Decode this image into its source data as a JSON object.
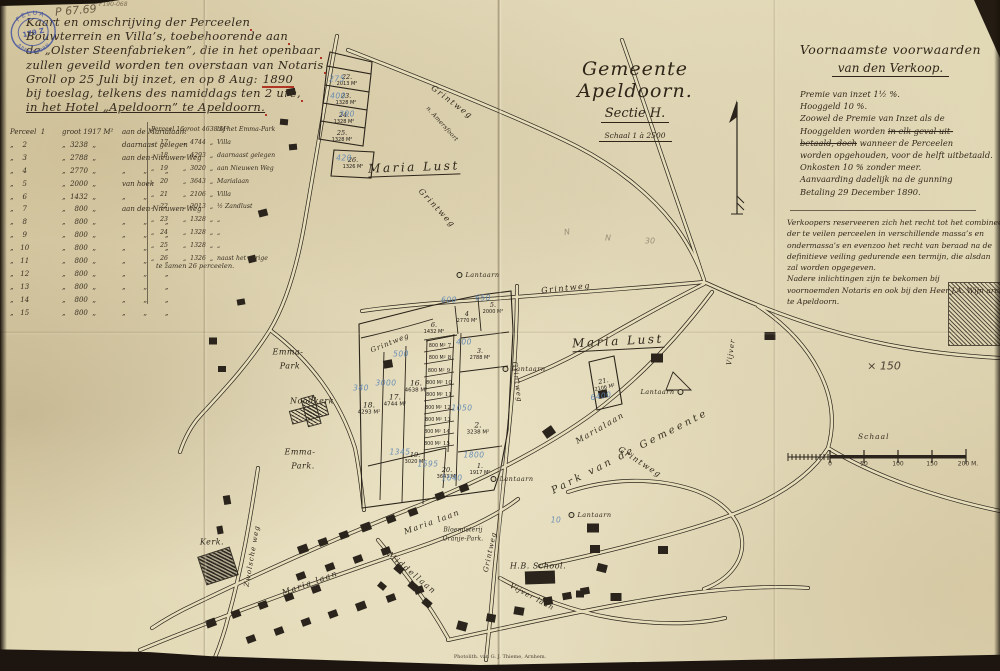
{
  "archive": {
    "stamp": {
      "arc_top": "FELUA",
      "center": "179 Z",
      "arc_bottom": "APELDOORN"
    },
    "ref_large": "P 67.69",
    "ref_small": "F190-068"
  },
  "title": {
    "lines": [
      {
        "t": "Kaart en omschrijving der Perceelen"
      },
      {
        "t": "Bouwterrein en Villa’s, toebehoorende aan"
      },
      {
        "t": "de „Olster Steenfabrieken”, die in het openbaar"
      },
      {
        "t": "zullen geveild worden ten overstaan van Notaris"
      },
      {
        "t": "Groll op 25 Juli bij inzet, en op 8 Aug: ",
        "red": "1890"
      },
      {
        "t": "bij toeslag, telkens des namiddags ten 2 ure,"
      },
      {
        "t": "in het Hotel „Apeldoorn” te Apeldoorn.",
        "cls": "und2"
      }
    ]
  },
  "sectie": {
    "line1": "Gemeente Apeldoorn.",
    "line2": "Sectie H.",
    "line3": "Schaal 1 à 2500"
  },
  "conditions": {
    "heading1": "Voornaamste voorwaarden",
    "heading2": "van den Verkoop.",
    "lines": [
      {
        "pre": "Premie van inzet 1½ %."
      },
      {
        "pre": "Hooggeld      10 %."
      },
      {
        "pre": "Zoowel de Premie van Inzet als de"
      },
      {
        "pre": "Hooggelden worden ",
        "struck": "in elk geval uit-"
      },
      {
        "struck": "betaald, doch",
        "post": " wanneer de Perceelen"
      },
      {
        "pre": "worden opgehouden, voor de helft uitbetaald."
      },
      {
        "pre": "Onkosten 10 % zonder meer."
      },
      {
        "pre": "Aanvaarding dadelijk na de gunning"
      },
      {
        "pre": "Betaling 29 December 1890."
      }
    ],
    "para2": [
      "Verkoopers reserveeren zich het recht tot het combineeren",
      "der te veilen perceelen in verschillende massa’s en",
      "ondermassa’s en evenzoo het recht van beraad na de",
      "definitieve veiling gedurende een termijn, die alsdan",
      "zal worden opgegeven.",
      "Nadere inlichtingen zijn te bekomen bij",
      "voornoemden Notaris en ook bij den Heer J.A. Wijn architect",
      "te Apeldoorn."
    ]
  },
  "parcel_table": {
    "left_rows": [
      {
        "no": "Perceel  1",
        "area": "groot 1917 M²",
        "note": "aan de Marialaan."
      },
      {
        "no": "„    2",
        "area": "„  3238  „",
        "note": "daarnaast gelegen"
      },
      {
        "no": "„    3",
        "area": "„  2788  „",
        "note": "aan den Nieuwen Weg"
      },
      {
        "no": "„    4",
        "area": "„  2770  „",
        "note": "„        „        „"
      },
      {
        "no": "„    5",
        "area": "„  2000  „",
        "note": "van hoek"
      },
      {
        "no": "„    6",
        "area": "„  1432  „",
        "note": "„        „"
      },
      {
        "no": "„    7",
        "area": "„    800  „",
        "note": "aan den Nieuwen Weg"
      },
      {
        "no": "„    8",
        "area": "„    800  „",
        "note": "„        „        „"
      },
      {
        "no": "„    9",
        "area": "„    800  „",
        "note": "„        „        „"
      },
      {
        "no": "„   10",
        "area": "„    800  „",
        "note": "„        „        „"
      },
      {
        "no": "„   11",
        "area": "„    800  „",
        "note": "„        „        „"
      },
      {
        "no": "„   12",
        "area": "„    800  „",
        "note": "„        „        „"
      },
      {
        "no": "„   13",
        "area": "„    800  „",
        "note": "„        „        „"
      },
      {
        "no": "„   14",
        "area": "„    800  „",
        "note": "„        „        „"
      },
      {
        "no": "„   15",
        "area": "„    800  „",
        "note": "„        „        „"
      }
    ],
    "right_rows": [
      {
        "no": "Perceel 16",
        "area": "groot 4638 M²",
        "note": "bij het Emma-Park"
      },
      {
        "no": "„   17",
        "area": "„  4744  „",
        "note": "Villa"
      },
      {
        "no": "„   18",
        "area": "„  4293  „",
        "note": "daarnaast gelegen"
      },
      {
        "no": "„   19",
        "area": "„  3020  „",
        "note": "aan Nieuwen Weg"
      },
      {
        "no": "„   20",
        "area": "„  3643  „",
        "note": "Marialaan"
      },
      {
        "no": "„   21",
        "area": "„  2106  „",
        "note": "Villa"
      },
      {
        "no": "„   22",
        "area": "„  2013  „",
        "note": "½ Zandlust"
      },
      {
        "no": "„   23",
        "area": "„  1328  „",
        "note": "„"
      },
      {
        "no": "„   24",
        "area": "„  1328  „",
        "note": "„"
      },
      {
        "no": "„   25",
        "area": "„  1328  „",
        "note": "„"
      },
      {
        "no": "„   26",
        "area": "„  1326  „",
        "note": "naast het vorige"
      }
    ],
    "footer": "te zamen 26 perceelen."
  },
  "map": {
    "labels": [
      {
        "t": "Maria Lust",
        "x": 414,
        "y": 168,
        "rot": -2,
        "cls": "big und"
      },
      {
        "t": "Maria Lust",
        "x": 618,
        "y": 342,
        "rot": -3,
        "cls": "big und"
      },
      {
        "t": "Grintweg",
        "x": 452,
        "y": 102,
        "rot": 37,
        "cls": "road"
      },
      {
        "t": "n. Amersfoort",
        "x": 442,
        "y": 124,
        "rot": 48,
        "cls": "tiny"
      },
      {
        "t": "Grintweg",
        "x": 437,
        "y": 208,
        "rot": 47,
        "cls": "road"
      },
      {
        "t": "Grintweg",
        "x": 566,
        "y": 288,
        "rot": -6,
        "cls": "road"
      },
      {
        "t": "Grintweg",
        "x": 390,
        "y": 343,
        "rot": -22,
        "cls": "road sm"
      },
      {
        "t": "Grintweg",
        "x": 517,
        "y": 382,
        "rot": 83,
        "cls": "road sm"
      },
      {
        "t": "Grintweg",
        "x": 640,
        "y": 462,
        "rot": 33,
        "cls": "road"
      },
      {
        "t": "Grintweg",
        "x": 490,
        "y": 552,
        "rot": -78,
        "cls": "road sm"
      },
      {
        "t": "Zwolsche weg",
        "x": 252,
        "y": 556,
        "rot": -80,
        "cls": "road sm"
      },
      {
        "t": "Marialaan",
        "x": 600,
        "y": 428,
        "rot": -30,
        "cls": "road"
      },
      {
        "t": "Park van de Gemeente",
        "x": 630,
        "y": 452,
        "rot": -27,
        "cls": "park"
      },
      {
        "t": "Vijver",
        "x": 731,
        "y": 352,
        "rot": -82,
        "cls": "road sm"
      },
      {
        "t": "Emma-",
        "x": 288,
        "y": 352,
        "cls": "place"
      },
      {
        "t": "Park",
        "x": 290,
        "y": 366,
        "cls": "place"
      },
      {
        "t": "Emma-",
        "x": 300,
        "y": 452,
        "cls": "place"
      },
      {
        "t": "Park.",
        "x": 303,
        "y": 466,
        "cls": "place"
      },
      {
        "t": "Noodkerk",
        "x": 312,
        "y": 401,
        "cls": "place sm"
      },
      {
        "t": "Kerk.",
        "x": 212,
        "y": 542,
        "cls": "place"
      },
      {
        "t": "Maria laan",
        "x": 310,
        "y": 583,
        "rot": -20,
        "cls": "road"
      },
      {
        "t": "Maria laan",
        "x": 432,
        "y": 522,
        "rot": -20,
        "cls": "road"
      },
      {
        "t": "Middellaan",
        "x": 412,
        "y": 573,
        "rot": 40,
        "cls": "road"
      },
      {
        "t": "Bloemisterij",
        "x": 463,
        "y": 530,
        "cls": "tiny"
      },
      {
        "t": "Oranje-Park.",
        "x": 463,
        "y": 539,
        "cls": "tiny"
      },
      {
        "t": "H.B. School.",
        "x": 538,
        "y": 566,
        "cls": "place sm"
      },
      {
        "t": "Vijver laan",
        "x": 532,
        "y": 597,
        "rot": 28,
        "cls": "road sm"
      }
    ],
    "parcels": [
      {
        "no": "22.",
        "area": "2013 M²",
        "x": 347,
        "y": 80,
        "cls": "sm"
      },
      {
        "no": "23.",
        "area": "1328 M²",
        "x": 346,
        "y": 99,
        "cls": "sm"
      },
      {
        "no": "24.",
        "area": "1328 M²",
        "x": 344,
        "y": 118,
        "cls": "sm"
      },
      {
        "no": "25.",
        "area": "1328 M²",
        "x": 342,
        "y": 136,
        "cls": "sm"
      },
      {
        "no": "26.",
        "area": "1326 M²",
        "x": 353,
        "y": 163,
        "cls": "sm"
      },
      {
        "no": "18.",
        "area": "4293 M²",
        "x": 369,
        "y": 408
      },
      {
        "no": "17.",
        "area": "4744 M²",
        "x": 395,
        "y": 400
      },
      {
        "no": "16.",
        "area": "4638 M²",
        "x": 416,
        "y": 386
      },
      {
        "no": "6.",
        "area": "1432 M²",
        "x": 434,
        "y": 328,
        "cls": "sm"
      },
      {
        "no": "4",
        "area": "2770 M²",
        "x": 467,
        "y": 317,
        "cls": "sm"
      },
      {
        "no": "5.",
        "area": "2000 M²",
        "x": 493,
        "y": 308,
        "cls": "sm"
      },
      {
        "no": "3.",
        "area": "2788 M²",
        "x": 480,
        "y": 354,
        "cls": "sm"
      },
      {
        "no": "2.",
        "area": "3238 M²",
        "x": 478,
        "y": 428
      },
      {
        "no": "1.",
        "area": "1917 M²",
        "x": 480,
        "y": 469,
        "cls": "sm"
      },
      {
        "no": "19.",
        "area": "3020 M²",
        "x": 415,
        "y": 458,
        "cls": "sm"
      },
      {
        "no": "20.",
        "area": "3643 M²",
        "x": 447,
        "y": 473,
        "cls": "sm"
      },
      {
        "no": "21.",
        "area": "2106 M²",
        "x": 604,
        "y": 384,
        "rot": -12,
        "cls": "sm"
      },
      {
        "no": "7",
        "area": "800 M²",
        "x": 440,
        "y": 346,
        "cls": "strip"
      },
      {
        "no": "8",
        "area": "800 M²",
        "x": 440,
        "y": 358,
        "cls": "strip"
      },
      {
        "no": "9",
        "area": "800 M²",
        "x": 439,
        "y": 371,
        "cls": "strip"
      },
      {
        "no": "10",
        "area": "800 M²",
        "x": 439,
        "y": 383,
        "cls": "strip"
      },
      {
        "no": "11",
        "area": "800 M²",
        "x": 439,
        "y": 395,
        "cls": "strip"
      },
      {
        "no": "12",
        "area": "800 M²",
        "x": 438,
        "y": 408,
        "cls": "strip"
      },
      {
        "no": "13",
        "area": "800 M²",
        "x": 438,
        "y": 420,
        "cls": "strip"
      },
      {
        "no": "14",
        "area": "800 M²",
        "x": 437,
        "y": 432,
        "cls": "strip"
      },
      {
        "no": "15",
        "area": "800 M²",
        "x": 437,
        "y": 444,
        "cls": "strip"
      }
    ],
    "blue_notes": [
      {
        "t": "275",
        "x": 337,
        "y": 79
      },
      {
        "t": "400",
        "x": 338,
        "y": 96
      },
      {
        "t": "390",
        "x": 347,
        "y": 114
      },
      {
        "t": "420",
        "x": 344,
        "y": 158
      },
      {
        "t": "500",
        "x": 401,
        "y": 354
      },
      {
        "t": "340",
        "x": 361,
        "y": 388
      },
      {
        "t": "3000",
        "x": 386,
        "y": 383
      },
      {
        "t": "400",
        "x": 464,
        "y": 342
      },
      {
        "t": "600",
        "x": 449,
        "y": 300
      },
      {
        "t": "650",
        "x": 483,
        "y": 298
      },
      {
        "t": "1050",
        "x": 462,
        "y": 408
      },
      {
        "t": "1345",
        "x": 400,
        "y": 452
      },
      {
        "t": "1595",
        "x": 428,
        "y": 464
      },
      {
        "t": "1800",
        "x": 474,
        "y": 455
      },
      {
        "t": "1640",
        "x": 452,
        "y": 478
      },
      {
        "t": "6400",
        "x": 601,
        "y": 396,
        "rot": -10
      },
      {
        "t": "10",
        "x": 556,
        "y": 520
      }
    ],
    "pencil_notes": [
      {
        "t": "N",
        "x": 567,
        "y": 232,
        "rot": -10
      },
      {
        "t": "N",
        "x": 608,
        "y": 238
      },
      {
        "t": "30",
        "x": 650,
        "y": 241
      },
      {
        "t": "× 150",
        "x": 884,
        "y": 366,
        "cls": "dark"
      }
    ],
    "lanterns": [
      {
        "x": 478,
        "y": 275,
        "label": "Lantaarn"
      },
      {
        "x": 524,
        "y": 369,
        "label": "Lantaarn"
      },
      {
        "x": 662,
        "y": 392,
        "label": "Lantaarn",
        "cls": "left"
      },
      {
        "x": 590,
        "y": 515,
        "label": "Lantaarn"
      },
      {
        "x": 512,
        "y": 479,
        "label": "Lantaarn"
      }
    ],
    "buildings": [
      {
        "x": 291,
        "y": 92,
        "w": 9,
        "h": 7,
        "rot": -10
      },
      {
        "x": 284,
        "y": 122,
        "w": 8,
        "h": 6,
        "rot": 5
      },
      {
        "x": 293,
        "y": 147,
        "w": 8,
        "h": 6,
        "rot": -5
      },
      {
        "x": 263,
        "y": 213,
        "w": 9,
        "h": 7,
        "rot": -15
      },
      {
        "x": 252,
        "y": 259,
        "w": 8,
        "h": 7,
        "rot": -15
      },
      {
        "x": 241,
        "y": 302,
        "w": 8,
        "h": 6,
        "rot": -10
      },
      {
        "x": 213,
        "y": 341,
        "w": 8,
        "h": 7,
        "rot": 0
      },
      {
        "x": 222,
        "y": 369,
        "w": 8,
        "h": 6,
        "rot": 0
      },
      {
        "x": 388,
        "y": 364,
        "w": 9,
        "h": 8,
        "rot": -10
      },
      {
        "x": 549,
        "y": 432,
        "w": 11,
        "h": 9,
        "rot": -35
      },
      {
        "x": 657,
        "y": 358,
        "w": 12,
        "h": 9,
        "rot": 0
      },
      {
        "x": 770,
        "y": 336,
        "w": 11,
        "h": 8,
        "rot": 0
      },
      {
        "x": 603,
        "y": 394,
        "w": 9,
        "h": 8,
        "rot": -12
      },
      {
        "x": 593,
        "y": 528,
        "w": 12,
        "h": 9,
        "rot": 0
      },
      {
        "x": 595,
        "y": 549,
        "w": 10,
        "h": 8,
        "rot": 0
      },
      {
        "x": 602,
        "y": 568,
        "w": 10,
        "h": 8,
        "rot": 15
      },
      {
        "x": 616,
        "y": 597,
        "w": 11,
        "h": 8,
        "rot": 0
      },
      {
        "x": 580,
        "y": 594,
        "w": 8,
        "h": 7,
        "rot": 0
      },
      {
        "x": 663,
        "y": 550,
        "w": 10,
        "h": 8,
        "rot": 0
      },
      {
        "x": 462,
        "y": 626,
        "w": 10,
        "h": 9,
        "rot": 15
      },
      {
        "x": 491,
        "y": 618,
        "w": 9,
        "h": 8,
        "rot": 10
      },
      {
        "x": 519,
        "y": 611,
        "w": 10,
        "h": 8,
        "rot": 10
      },
      {
        "x": 548,
        "y": 601,
        "w": 9,
        "h": 8,
        "rot": -10
      },
      {
        "x": 567,
        "y": 596,
        "w": 9,
        "h": 7,
        "rot": -10
      },
      {
        "x": 585,
        "y": 591,
        "w": 9,
        "h": 7,
        "rot": -10
      },
      {
        "x": 303,
        "y": 549,
        "w": 10,
        "h": 8,
        "rot": -20
      },
      {
        "x": 323,
        "y": 542,
        "w": 9,
        "h": 7,
        "rot": -20
      },
      {
        "x": 344,
        "y": 535,
        "w": 9,
        "h": 7,
        "rot": -20
      },
      {
        "x": 366,
        "y": 527,
        "w": 10,
        "h": 8,
        "rot": -20
      },
      {
        "x": 391,
        "y": 519,
        "w": 9,
        "h": 7,
        "rot": -20
      },
      {
        "x": 413,
        "y": 512,
        "w": 9,
        "h": 7,
        "rot": -20
      },
      {
        "x": 301,
        "y": 576,
        "w": 9,
        "h": 7,
        "rot": -20
      },
      {
        "x": 330,
        "y": 567,
        "w": 9,
        "h": 7,
        "rot": -20
      },
      {
        "x": 358,
        "y": 559,
        "w": 9,
        "h": 7,
        "rot": -20
      },
      {
        "x": 386,
        "y": 551,
        "w": 9,
        "h": 7,
        "rot": -20
      },
      {
        "x": 211,
        "y": 623,
        "w": 10,
        "h": 8,
        "rot": -20
      },
      {
        "x": 236,
        "y": 614,
        "w": 9,
        "h": 7,
        "rot": -20
      },
      {
        "x": 263,
        "y": 605,
        "w": 9,
        "h": 7,
        "rot": -20
      },
      {
        "x": 289,
        "y": 597,
        "w": 9,
        "h": 7,
        "rot": -20
      },
      {
        "x": 316,
        "y": 589,
        "w": 9,
        "h": 7,
        "rot": -20
      },
      {
        "x": 251,
        "y": 639,
        "w": 9,
        "h": 7,
        "rot": -20
      },
      {
        "x": 279,
        "y": 631,
        "w": 9,
        "h": 7,
        "rot": -20
      },
      {
        "x": 306,
        "y": 622,
        "w": 9,
        "h": 7,
        "rot": -20
      },
      {
        "x": 333,
        "y": 614,
        "w": 9,
        "h": 7,
        "rot": -20
      },
      {
        "x": 361,
        "y": 606,
        "w": 10,
        "h": 8,
        "rot": -20
      },
      {
        "x": 391,
        "y": 598,
        "w": 9,
        "h": 7,
        "rot": -20
      },
      {
        "x": 419,
        "y": 590,
        "w": 9,
        "h": 7,
        "rot": -20
      },
      {
        "x": 399,
        "y": 569,
        "w": 9,
        "h": 7,
        "rot": 40
      },
      {
        "x": 413,
        "y": 586,
        "w": 9,
        "h": 7,
        "rot": 40
      },
      {
        "x": 427,
        "y": 603,
        "w": 9,
        "h": 7,
        "rot": 40
      },
      {
        "x": 382,
        "y": 586,
        "w": 8,
        "h": 6,
        "rot": 40
      },
      {
        "x": 227,
        "y": 500,
        "w": 9,
        "h": 7,
        "rot": 80
      },
      {
        "x": 220,
        "y": 530,
        "w": 8,
        "h": 6,
        "rot": 80
      },
      {
        "x": 440,
        "y": 496,
        "w": 9,
        "h": 7,
        "rot": -20
      },
      {
        "x": 464,
        "y": 488,
        "w": 9,
        "h": 7,
        "rot": -20
      }
    ],
    "scalebar": {
      "title": "Schaal",
      "ticks": [
        {
          "t": "0",
          "x": 830
        },
        {
          "t": "50",
          "x": 864
        },
        {
          "t": "100",
          "x": 898
        },
        {
          "t": "150",
          "x": 932
        },
        {
          "t": "200 M.",
          "x": 968
        }
      ]
    },
    "credit": "Photolith. van G. J. Thieme, Arnhem."
  }
}
